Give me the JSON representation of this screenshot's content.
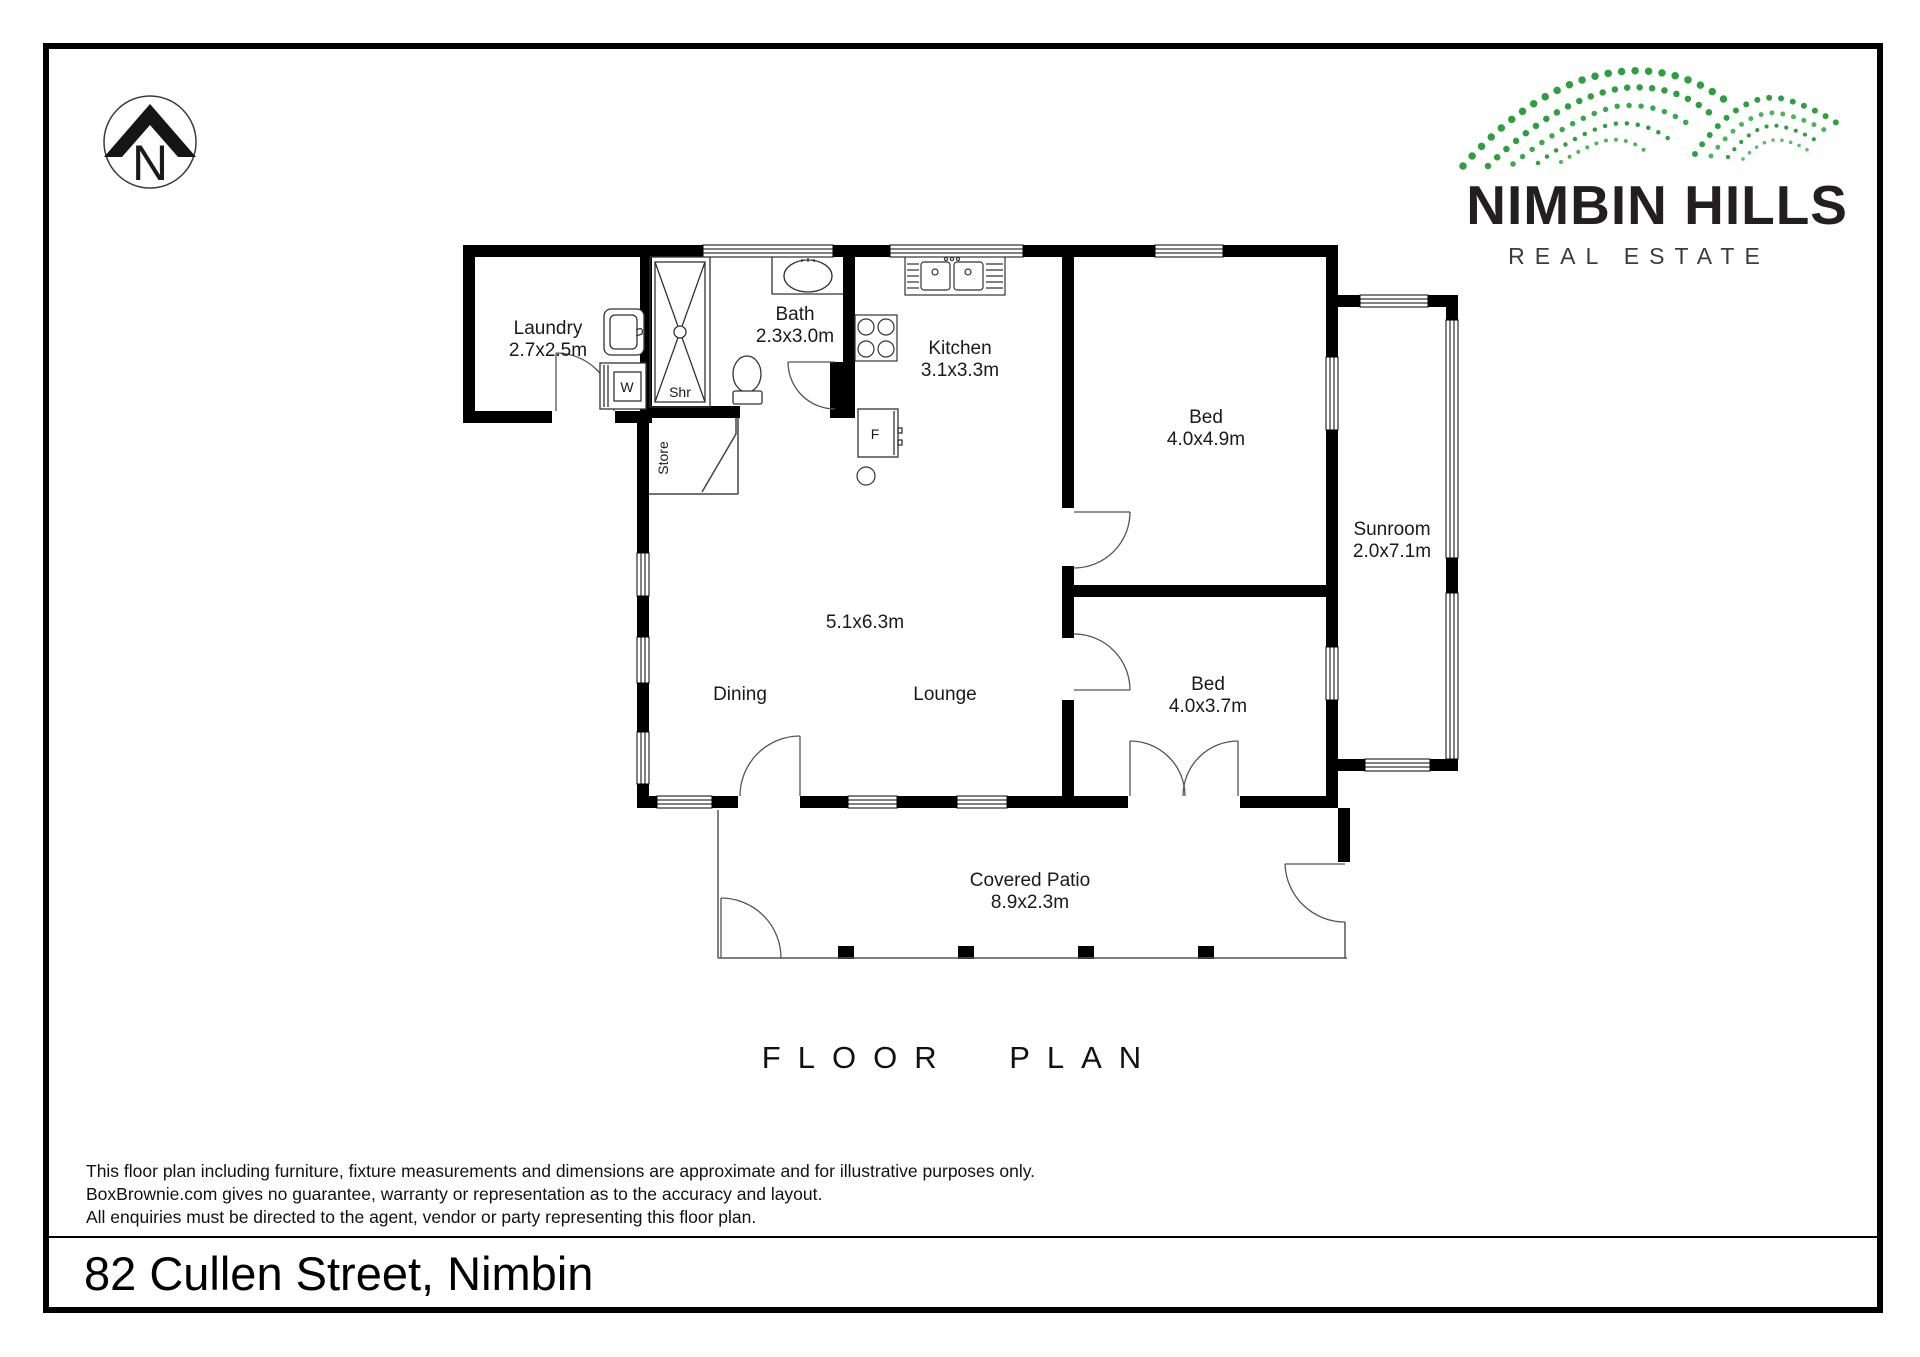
{
  "compass": {
    "letter": "N"
  },
  "logo": {
    "name": "NIMBIN HILLS",
    "tagline": "REAL ESTATE",
    "accent_green": "#2f9e41"
  },
  "plan": {
    "rooms": {
      "laundry": {
        "name": "Laundry",
        "dims": "2.7x2.5m"
      },
      "bath": {
        "name": "Bath",
        "dims": "2.3x3.0m"
      },
      "kitchen": {
        "name": "Kitchen",
        "dims": "3.1x3.3m"
      },
      "bed1": {
        "name": "Bed",
        "dims": "4.0x4.9m"
      },
      "bed2": {
        "name": "Bed",
        "dims": "4.0x3.7m"
      },
      "sunroom": {
        "name": "Sunroom",
        "dims": "2.0x7.1m"
      },
      "living": {
        "dims": "5.1x6.3m",
        "dining": "Dining",
        "lounge": "Lounge"
      },
      "patio": {
        "name": "Covered Patio",
        "dims": "8.9x2.3m"
      },
      "store": {
        "name": "Store"
      }
    },
    "fixtures": {
      "shower": "Shr",
      "washer": "W",
      "fridge": "F"
    }
  },
  "title": "FLOOR PLAN",
  "disclaimer": {
    "lines": [
      "This floor plan including furniture, fixture measurements and dimensions are approximate and for illustrative purposes only.",
      "BoxBrownie.com gives no guarantee, warranty or representation as to the accuracy and layout.",
      "All enquiries must be directed to the agent, vendor or party representing this floor plan."
    ]
  },
  "address": "82 Cullen Street, Nimbin"
}
